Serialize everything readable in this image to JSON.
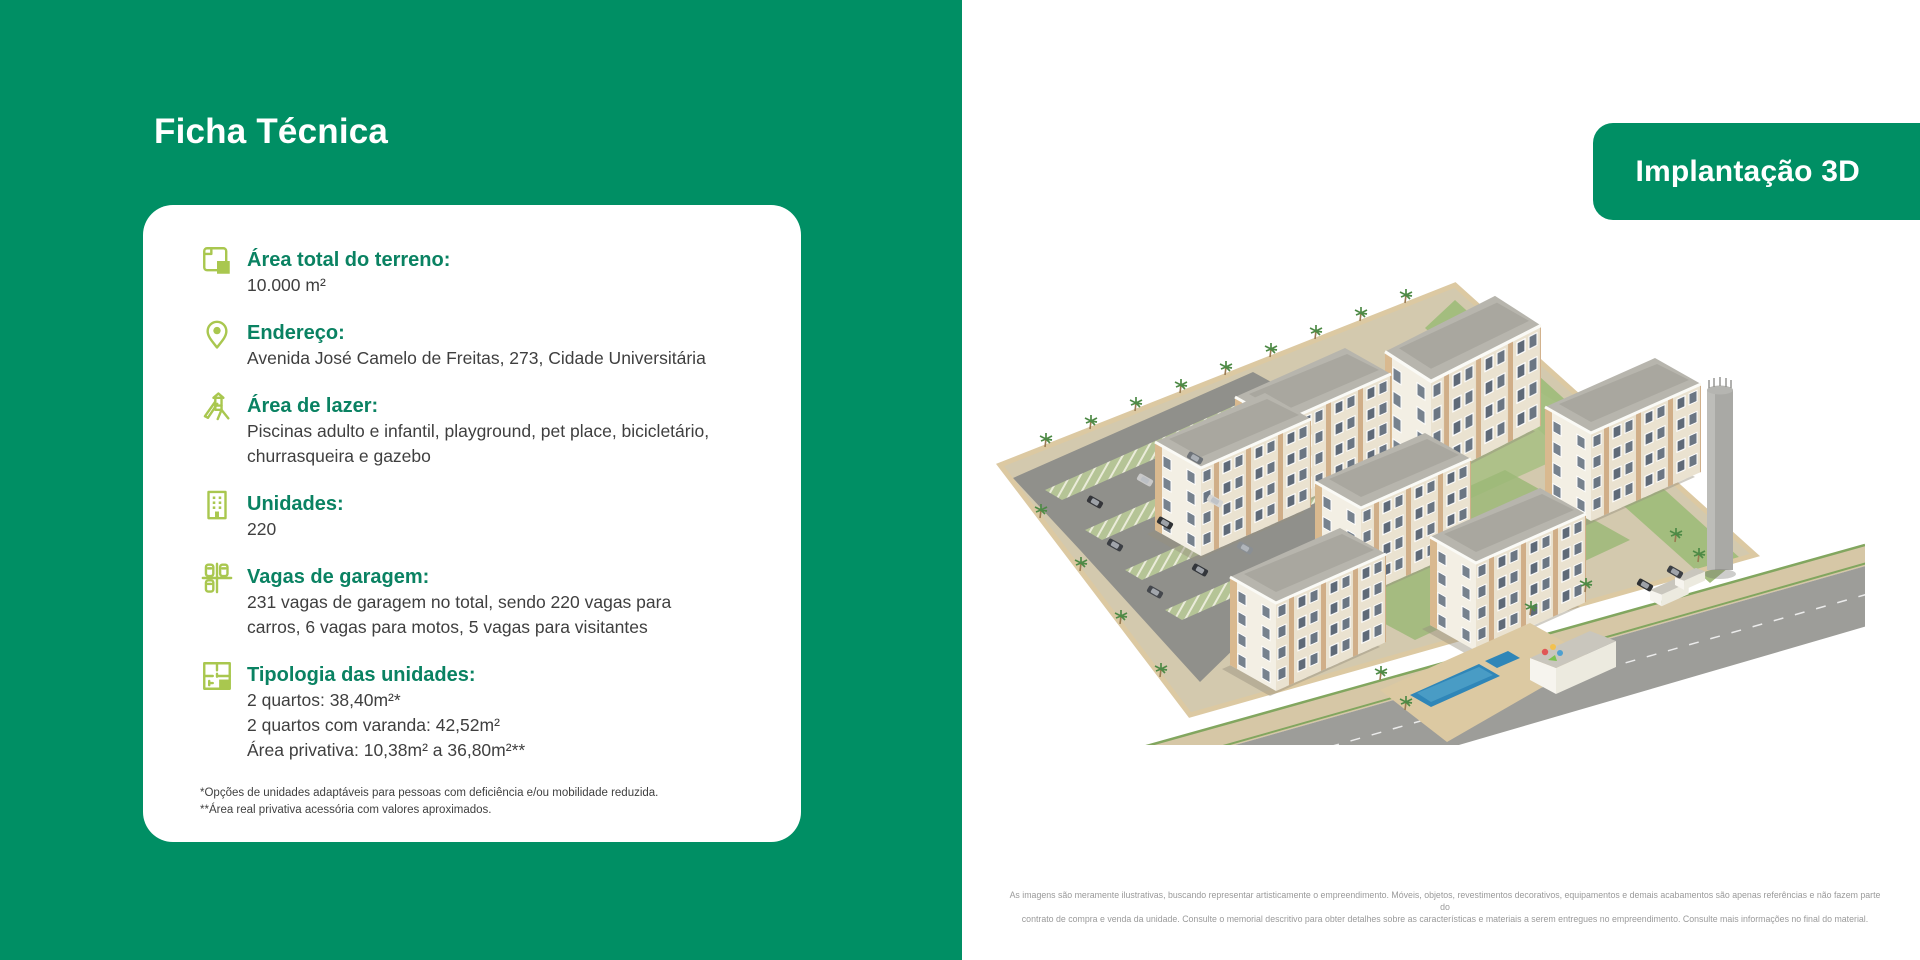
{
  "colors": {
    "brand_green": "#008F64",
    "heading_teal": "#0A8262",
    "icon_lime": "#A9C74F",
    "body_text": "#3F3F3F",
    "disclaimer_gray": "#9A9A9A",
    "card_bg": "#FFFFFF"
  },
  "left_panel": {
    "title": "Ficha Técnica",
    "card": {
      "items": [
        {
          "icon": "area-icon",
          "label": "Área total do terreno:",
          "lines": [
            "10.000 m²"
          ]
        },
        {
          "icon": "location-pin-icon",
          "label": "Endereço:",
          "lines": [
            "Avenida José Camelo de Freitas, 273, Cidade Universitária"
          ]
        },
        {
          "icon": "playground-icon",
          "label": "Área de lazer:",
          "lines": [
            "Piscinas adulto e infantil, playground, pet place, bicicletário,",
            "churrasqueira e gazebo"
          ]
        },
        {
          "icon": "building-icon",
          "label": "Unidades:",
          "lines": [
            "220"
          ]
        },
        {
          "icon": "parking-icon",
          "label": "Vagas de garagem:",
          "lines": [
            "231 vagas de garagem no total, sendo 220 vagas para",
            "carros, 6 vagas para motos, 5 vagas para visitantes"
          ]
        },
        {
          "icon": "floorplan-icon",
          "label": "Tipologia das unidades:",
          "lines": [
            "2 quartos: 38,40m²*",
            "2 quartos com varanda: 42,52m²",
            "Área privativa: 10,38m² a 36,80m²**"
          ]
        }
      ],
      "footnotes": [
        "*Opções de unidades adaptáveis para pessoas com deficiência e/ou mobilidade reduzida.",
        "**Área real privativa acessória com valores aproximados."
      ]
    }
  },
  "right_panel": {
    "badge_label": "Implantação 3D",
    "disclaimer_lines": [
      "As imagens são meramente ilustrativas, buscando representar artisticamente o empreendimento. Móveis, objetos, revestimentos decorativos, equipamentos e demais acabamentos são apenas referências e não fazem parte do",
      "contrato de compra e venda da unidade. Consulte o memorial descritivo para obter detalhes sobre as características e materiais a serem entregues no empreendimento. Consulte mais informações no final do material."
    ]
  }
}
